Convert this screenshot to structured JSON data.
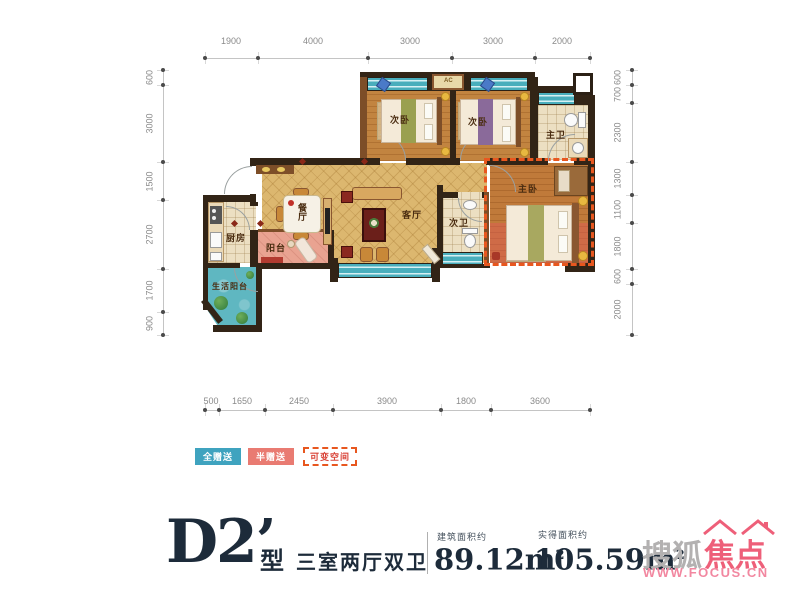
{
  "plan": {
    "rooms": {
      "bedroom_a": "次卧",
      "bedroom_b": "次卧",
      "master_bath": "主卫",
      "master_bedroom": "主卧",
      "second_bath": "次卫",
      "living": "客厅",
      "dining": "餐厅",
      "kitchen": "厨房",
      "balcony": "阳台",
      "utility_balcony": "生活阳台",
      "ac": "AC"
    },
    "dims": {
      "top": [
        "1900",
        "4000",
        "3000",
        "3000",
        "2000"
      ],
      "bottom": [
        "500",
        "1650",
        "2450",
        "3900",
        "1800",
        "3600"
      ],
      "left": [
        "600",
        "3000",
        "1500",
        "2700",
        "1700",
        "900"
      ],
      "right": [
        "600",
        "700",
        "2300",
        "1300",
        "1100",
        "1800",
        "600",
        "2000"
      ]
    }
  },
  "legend": [
    {
      "label": "全赠送",
      "color": "#3fa3bf",
      "style": "solid"
    },
    {
      "label": "半赠送",
      "color": "#e97b72",
      "style": "solid"
    },
    {
      "label": "可变空间",
      "color": "#e8571f",
      "style": "dashed"
    }
  ],
  "footer": {
    "plan_code": "D2’",
    "type_suffix": "型",
    "layout": "三室两厅双卫",
    "built_area_label": "建筑面积约",
    "built_area_value": "89.12m",
    "usable_area_label": "实得面积约",
    "usable_area_value": "105.59m",
    "area_sup": "2"
  },
  "watermark": {
    "brand_gray": "搜狐",
    "brand_pink": "焦点",
    "url": "WWW.FOCUS.CN"
  },
  "colors": {
    "legend_full_gift": "#3fa3bf",
    "legend_half_gift": "#e97b72",
    "variable_space_dash": "#e8571f",
    "window_teal": "#49aebc",
    "floor_gold": "#dcb76f",
    "wall_dark": "#322416",
    "title_navy": "#1d2b3a",
    "watermark_pink": "#ee5f79"
  }
}
